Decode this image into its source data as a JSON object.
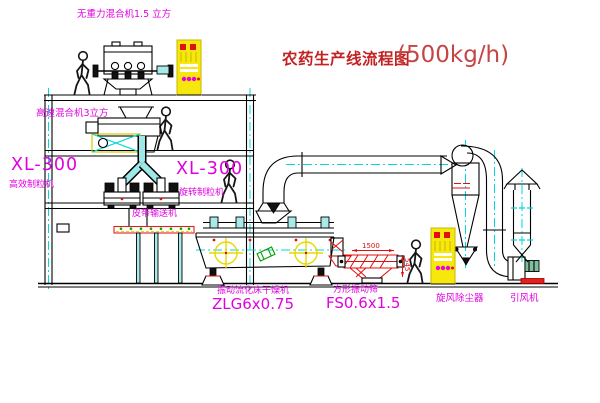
{
  "title": {
    "text_zh": "农药生产线流程图",
    "capacity": "(500kg/h)"
  },
  "equipment_labels": {
    "gravity_mixer": "无重力混合机1.5 立方",
    "high_speed_mixer": "高速混合机3立方",
    "granulator_left_model": "XL-300",
    "granulator_left_name": "高效制粒机",
    "granulator_center_model": "XL-300",
    "granulator_center_name": "旋转制粒机",
    "belt_conveyor": "皮带输送机",
    "fluid_bed_dryer_name": "振动流化床干燥机",
    "fluid_bed_dryer_model": "ZLG6x0.75",
    "square_sieve_name": "方形振动筛",
    "square_sieve_model": "FS0.6x1.5",
    "cyclone": "旋风除尘器",
    "draft_fan": "引风机"
  },
  "dimensions": {
    "sieve_length": "1500",
    "sieve_height": "545"
  },
  "colors": {
    "label_magenta": "#E100E1",
    "title_red": "#C22222",
    "cad_cyan": "#00D9D9",
    "cad_yellow": "#F2E20A",
    "cad_red": "#E01010",
    "cad_green": "#00A000",
    "line_black": "#000000",
    "background": "#FFFFFF"
  }
}
